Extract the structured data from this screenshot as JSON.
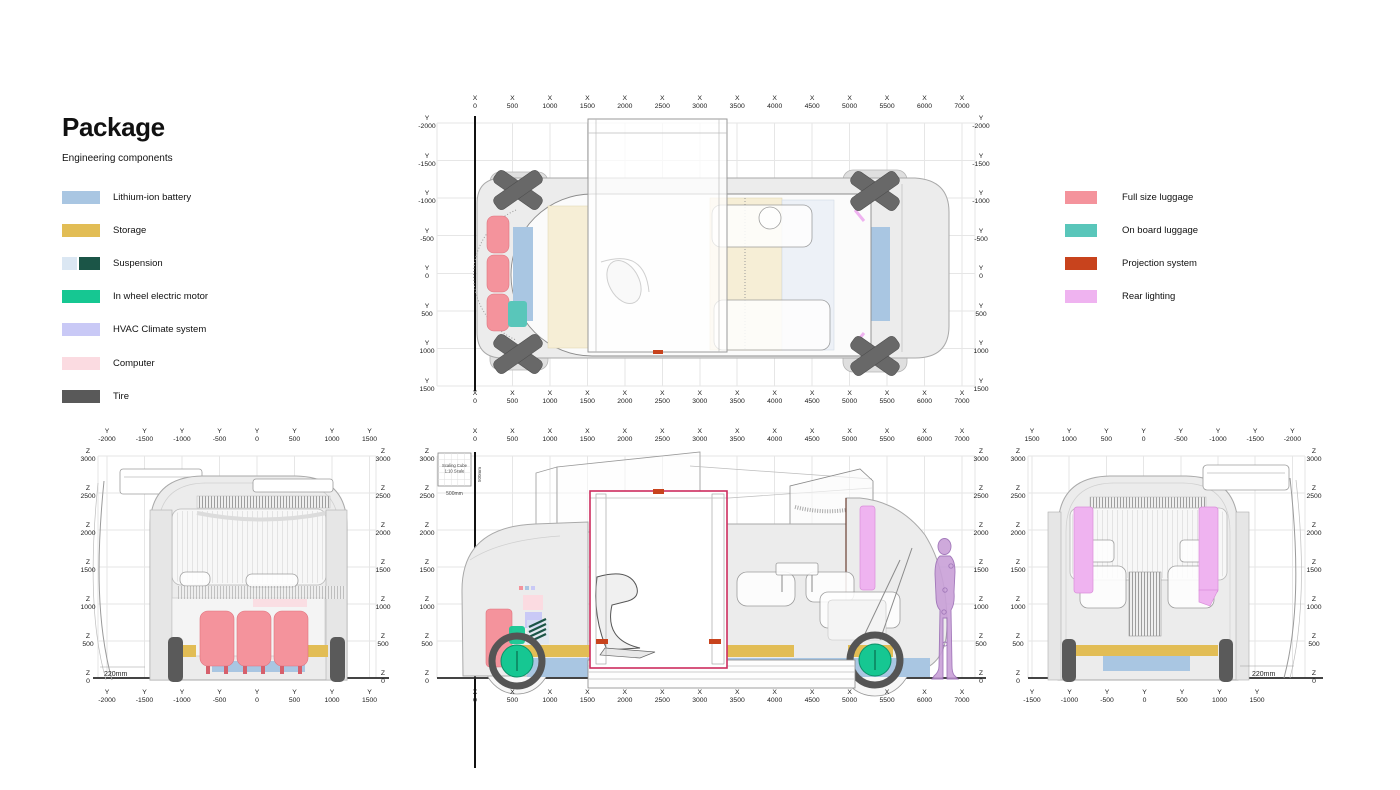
{
  "title": "Package",
  "subtitle": "Engineering components",
  "colors": {
    "battery": "#a9c6e2",
    "storage": "#e2bd55",
    "suspension_light": "#dbe7f3",
    "suspension_dark": "#1b5547",
    "motor": "#16c792",
    "hvac": "#c9c9f6",
    "computer": "#fbdbe1",
    "tire": "#595959",
    "full_size_luggage": "#f4939c",
    "on_board_luggage": "#59c6ba",
    "projection": "#c8431d",
    "rear_lighting": "#efb3f0",
    "door_frame": "#cd2c5e",
    "human_figure": "#c9a0d8"
  },
  "legend_left": {
    "items": [
      {
        "name": "lithium-ion-battery",
        "label": "Lithium-ion battery",
        "colors": [
          "#a9c6e2"
        ]
      },
      {
        "name": "storage",
        "label": "Storage",
        "colors": [
          "#e2bd55"
        ]
      },
      {
        "name": "suspension",
        "label": "Suspension",
        "colors": [
          "#dbe7f3",
          "#1b5547"
        ]
      },
      {
        "name": "in-wheel-electric-motor",
        "label": "In wheel electric motor",
        "colors": [
          "#16c792"
        ]
      },
      {
        "name": "hvac-climate-system",
        "label": "HVAC Climate system",
        "colors": [
          "#c9c9f6"
        ]
      },
      {
        "name": "computer",
        "label": "Computer",
        "colors": [
          "#fbdbe1"
        ]
      },
      {
        "name": "tire",
        "label": "Tire",
        "colors": [
          "#595959"
        ]
      }
    ]
  },
  "legend_right": {
    "items": [
      {
        "name": "full-size-luggage",
        "label": "Full size luggage",
        "colors": [
          "#f4939c"
        ]
      },
      {
        "name": "on-board-luggage",
        "label": "On board luggage",
        "colors": [
          "#59c6ba"
        ]
      },
      {
        "name": "projection-system",
        "label": "Projection system",
        "colors": [
          "#c8431d"
        ]
      },
      {
        "name": "rear-lighting",
        "label": "Rear lighting",
        "colors": [
          "#efb3f0"
        ]
      }
    ]
  },
  "views": {
    "top": {
      "x_axis_letter": "X",
      "x_ticks": [
        0,
        500,
        1000,
        1500,
        2000,
        2500,
        3000,
        3500,
        4000,
        4500,
        5000,
        5500,
        6000,
        7000
      ],
      "y_axis_letter": "Y",
      "y_ticks": [
        -2000,
        -1500,
        -1000,
        -500,
        0,
        500,
        1000,
        1500
      ]
    },
    "front": {
      "y_axis_letter": "Y",
      "y_ticks": [
        -2000,
        -1500,
        -1000,
        -500,
        0,
        500,
        1000,
        1500
      ],
      "z_axis_letter": "Z",
      "z_ticks": [
        3000,
        2500,
        2000,
        1500,
        1000,
        500,
        0
      ],
      "clearance_label": "220mm"
    },
    "side": {
      "x_axis_letter": "X",
      "x_ticks": [
        0,
        500,
        1000,
        1500,
        2000,
        2500,
        3000,
        3500,
        4000,
        4500,
        5000,
        5500,
        6000,
        7000
      ],
      "z_axis_letter": "Z",
      "z_ticks": [
        3000,
        2500,
        2000,
        1500,
        1000,
        500,
        0
      ],
      "scaling_cube": {
        "line1": "Scaling Cube",
        "line2": "1:10 Scale",
        "bottom_label": "500mm",
        "side_label": "500mm"
      }
    },
    "rear": {
      "y_axis_letter": "Y",
      "y_ticks_top": [
        1500,
        1000,
        500,
        0,
        -500,
        -1000,
        -1500,
        -2000
      ],
      "y_ticks_bottom": [
        -1500,
        -1000,
        -500,
        0,
        500,
        1000,
        1500
      ],
      "z_axis_letter": "Z",
      "z_ticks": [
        3000,
        2500,
        2000,
        1500,
        1000,
        500,
        0
      ],
      "clearance_label": "220mm"
    }
  }
}
